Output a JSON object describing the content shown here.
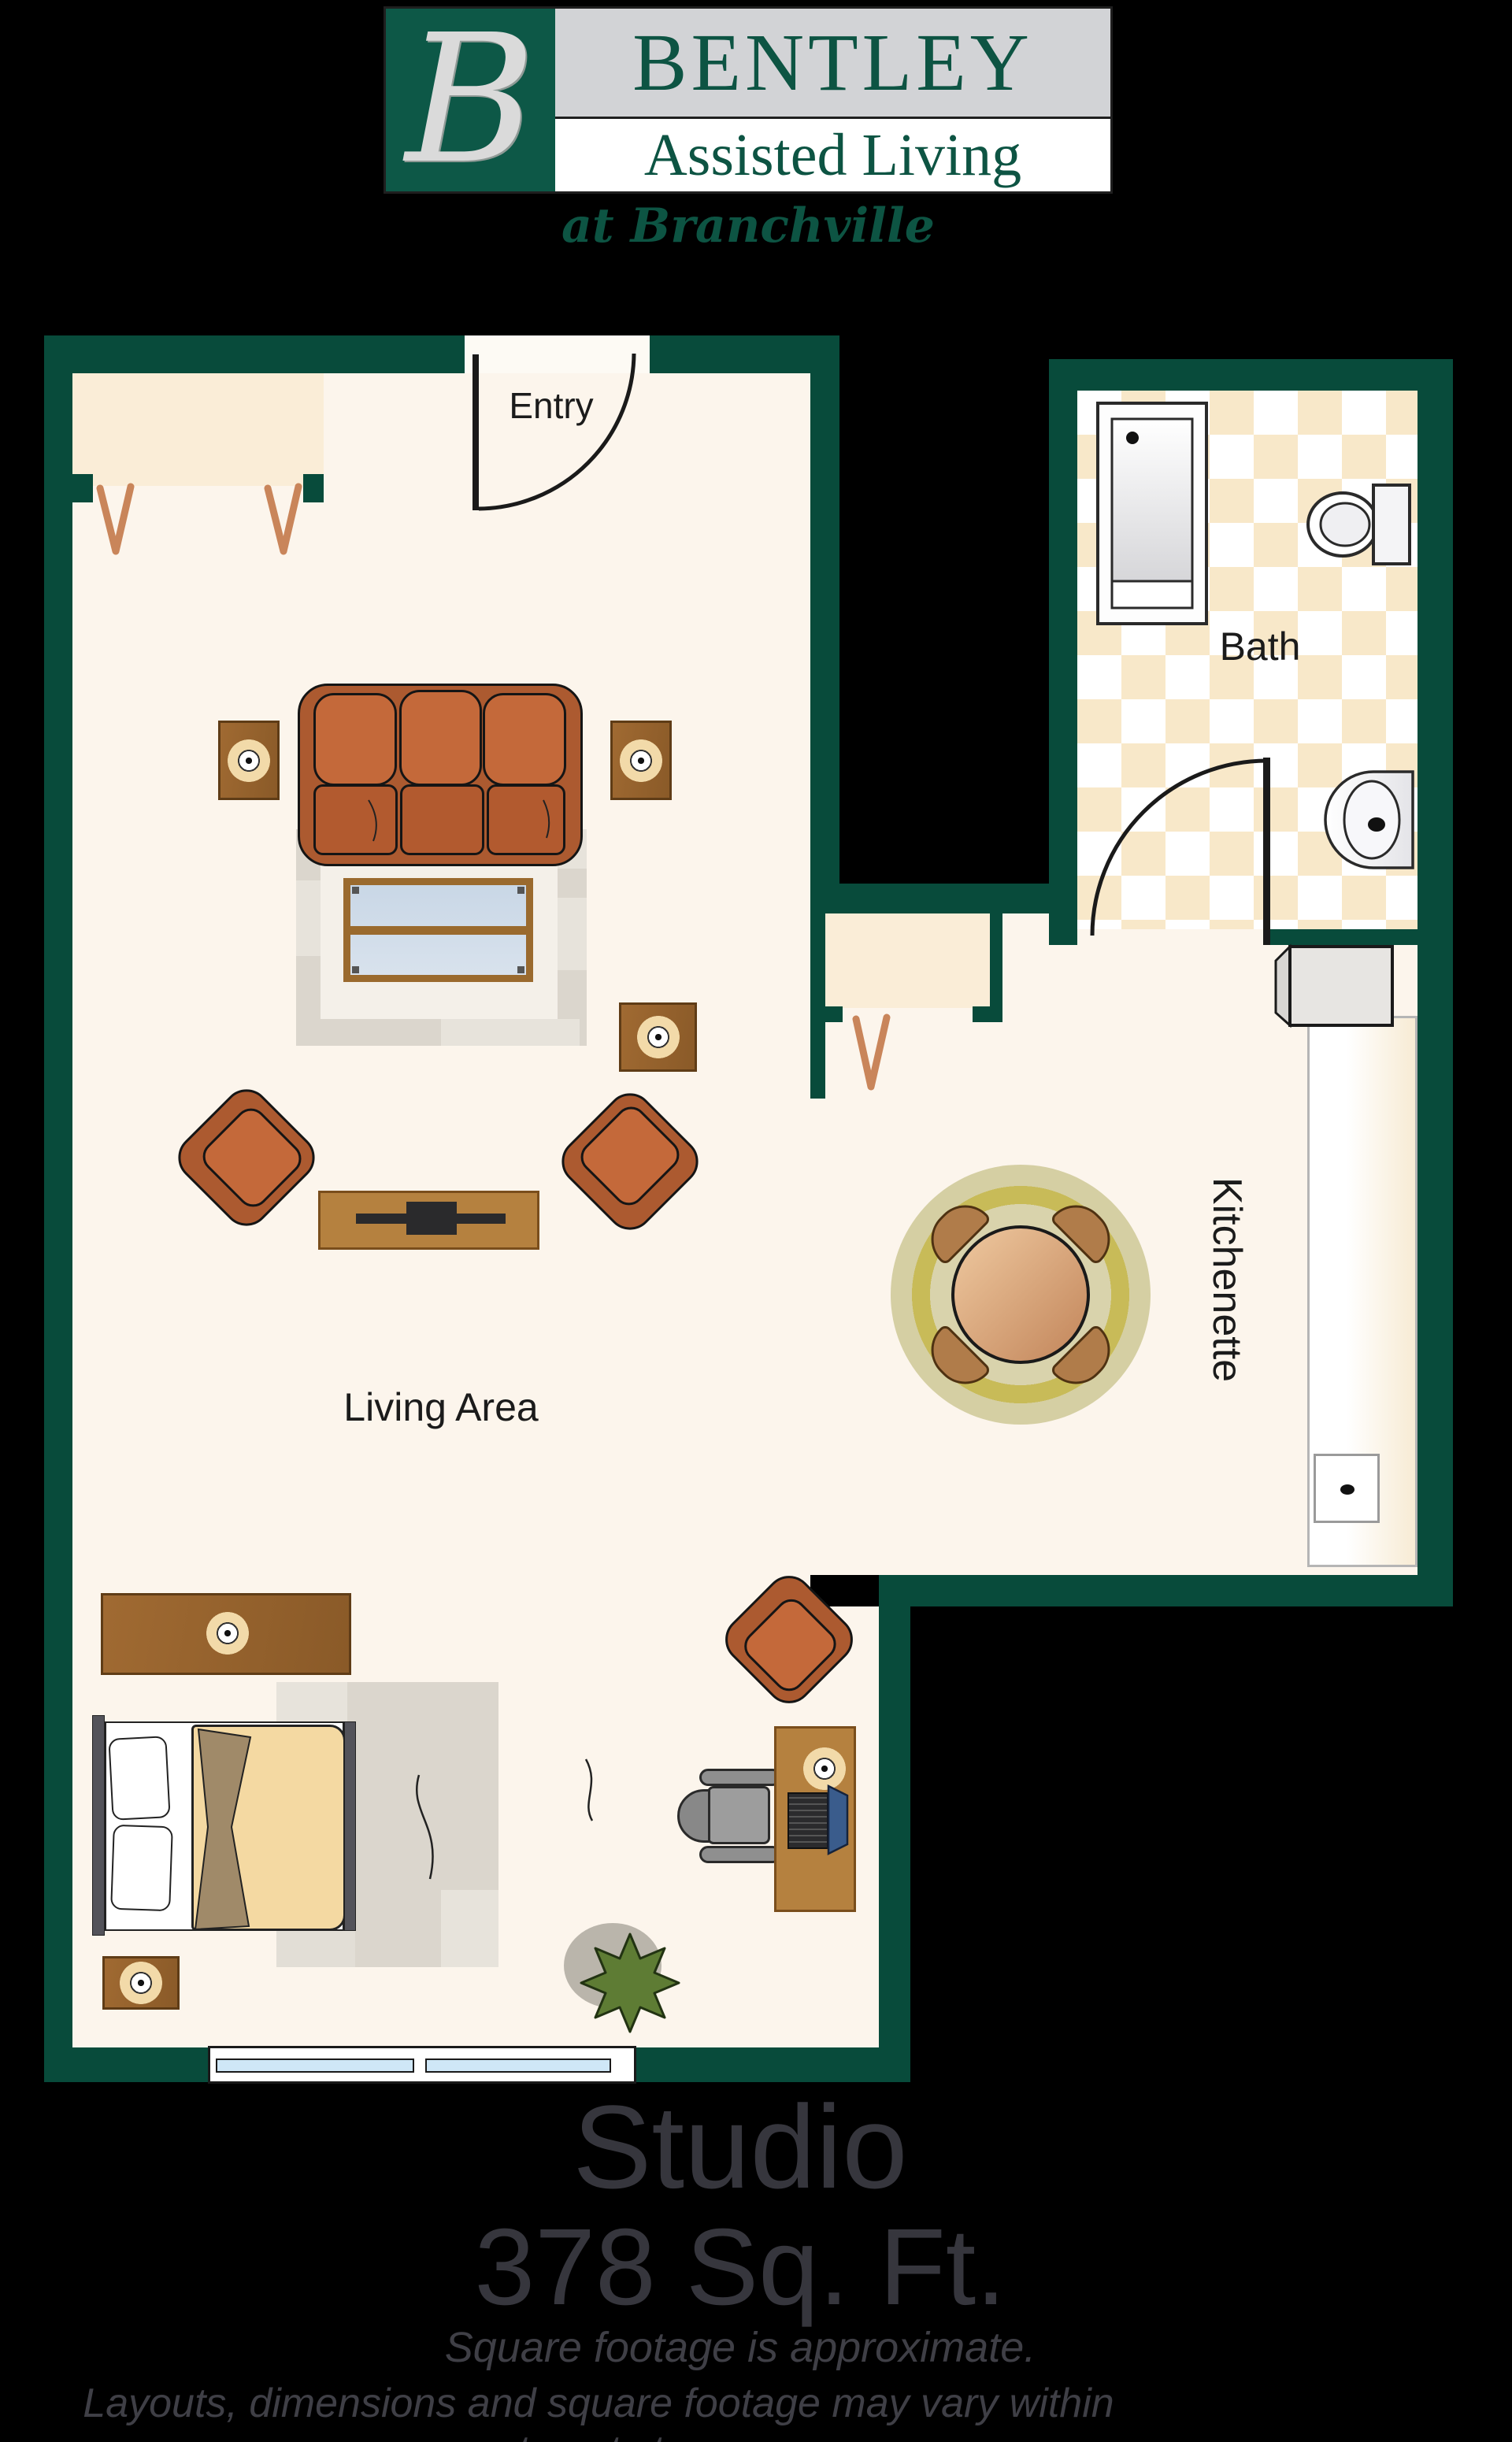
{
  "logo": {
    "initial": "B",
    "name": "BENTLEY",
    "subtitle": "Assisted Living",
    "tagline": "at Branchville"
  },
  "rooms": {
    "entry": "Entry",
    "bath": "Bath",
    "kitchenette": "Kitchenette",
    "living": "Living Area"
  },
  "caption": {
    "title": "Studio",
    "area": "378 Sq. Ft.",
    "note1": "Square footage is approximate.",
    "note2": "Layouts, dimensions and square footage may vary within apartments types."
  },
  "colors": {
    "wall": "#084B3B",
    "floor": "#FCF5EC",
    "floor_bright": "#FDFAF4",
    "closet": "#FAEDD7",
    "tile_cream": "#F8E8C9",
    "logo_green": "#0D5847",
    "logo_text": "#0D5443",
    "logo_band": "#D2D3D6",
    "logo_initial": "#DADADA",
    "title_text": "#36363D",
    "note_text": "#3F3F46",
    "label_text": "#1B1B1B",
    "hanger": "#C9855A",
    "sofa": "#AC5A30",
    "cushion": "#C4693A",
    "seat_cushion": "#B25A2F",
    "wood": "#B5813F",
    "wood_dark": "#7A4E1C",
    "table_light": "#A06A32",
    "table_dark": "#8A5A28",
    "table_border": "#5F3C16",
    "lamp_base": "#F2DAA9",
    "rug": "#DBD6CD",
    "rug_patch": "#E7E3DB",
    "mat": "#F4F0E9",
    "glass_frame": "#9A6A2E",
    "comforter": "#F4D9A2",
    "fold": "#A08A69",
    "olive_outer": "#D5CFA3",
    "olive_ring": "#C8BB58",
    "olive_inner": "#D9D3AC",
    "olive_center": "#DFDABB",
    "dining_table_light": "#EFC9A0",
    "dining_table_dark": "#C2855A",
    "chair_wood": "#B07C4A",
    "chair_wood_border": "#4F3212",
    "window_glass": "#CFE7F7",
    "plant": "#5E7C34",
    "plant_shadow": "#BAB5AB",
    "office_gray": "#9D9D9D"
  }
}
